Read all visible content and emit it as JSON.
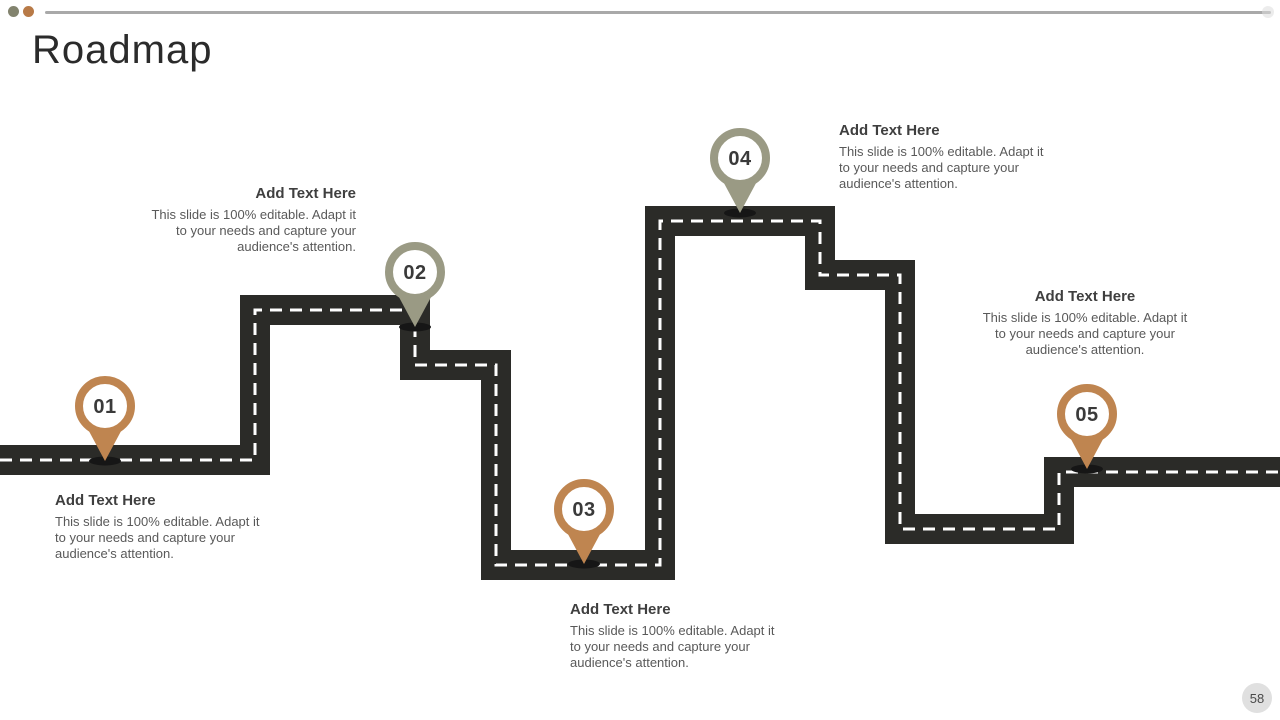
{
  "slide": {
    "title": "Roadmap",
    "page_number": "58"
  },
  "decor": {
    "dot_olive_color": "#82836e",
    "dot_brown_color": "#b87a47",
    "top_line_color": "#a9a9a9"
  },
  "road": {
    "color": "#2b2b28",
    "dash_color": "#ffffff"
  },
  "milestones": [
    {
      "number": "01",
      "pin_color": "#bf8550",
      "heading": "Add Text Here",
      "body_lines": [
        "This slide is 100% editable. Adapt it",
        "to your needs and capture your",
        "audience's attention."
      ]
    },
    {
      "number": "02",
      "pin_color": "#9a9a84",
      "heading": "Add Text Here",
      "body_lines": [
        "This slide is 100% editable. Adapt it",
        "to your needs and capture your",
        "audience's attention."
      ]
    },
    {
      "number": "03",
      "pin_color": "#bf8550",
      "heading": "Add Text Here",
      "body_lines": [
        "This slide is 100% editable. Adapt it",
        "to your needs and capture your",
        "audience's attention."
      ]
    },
    {
      "number": "04",
      "pin_color": "#9a9a84",
      "heading": "Add Text Here",
      "body_lines": [
        "This slide is 100% editable. Adapt it",
        "to your needs and capture your",
        "audience's attention."
      ]
    },
    {
      "number": "05",
      "pin_color": "#bf8550",
      "heading": "Add Text Here",
      "body_lines": [
        "This slide is 100% editable. Adapt it",
        "to your needs and capture your",
        "audience's attention."
      ]
    }
  ]
}
